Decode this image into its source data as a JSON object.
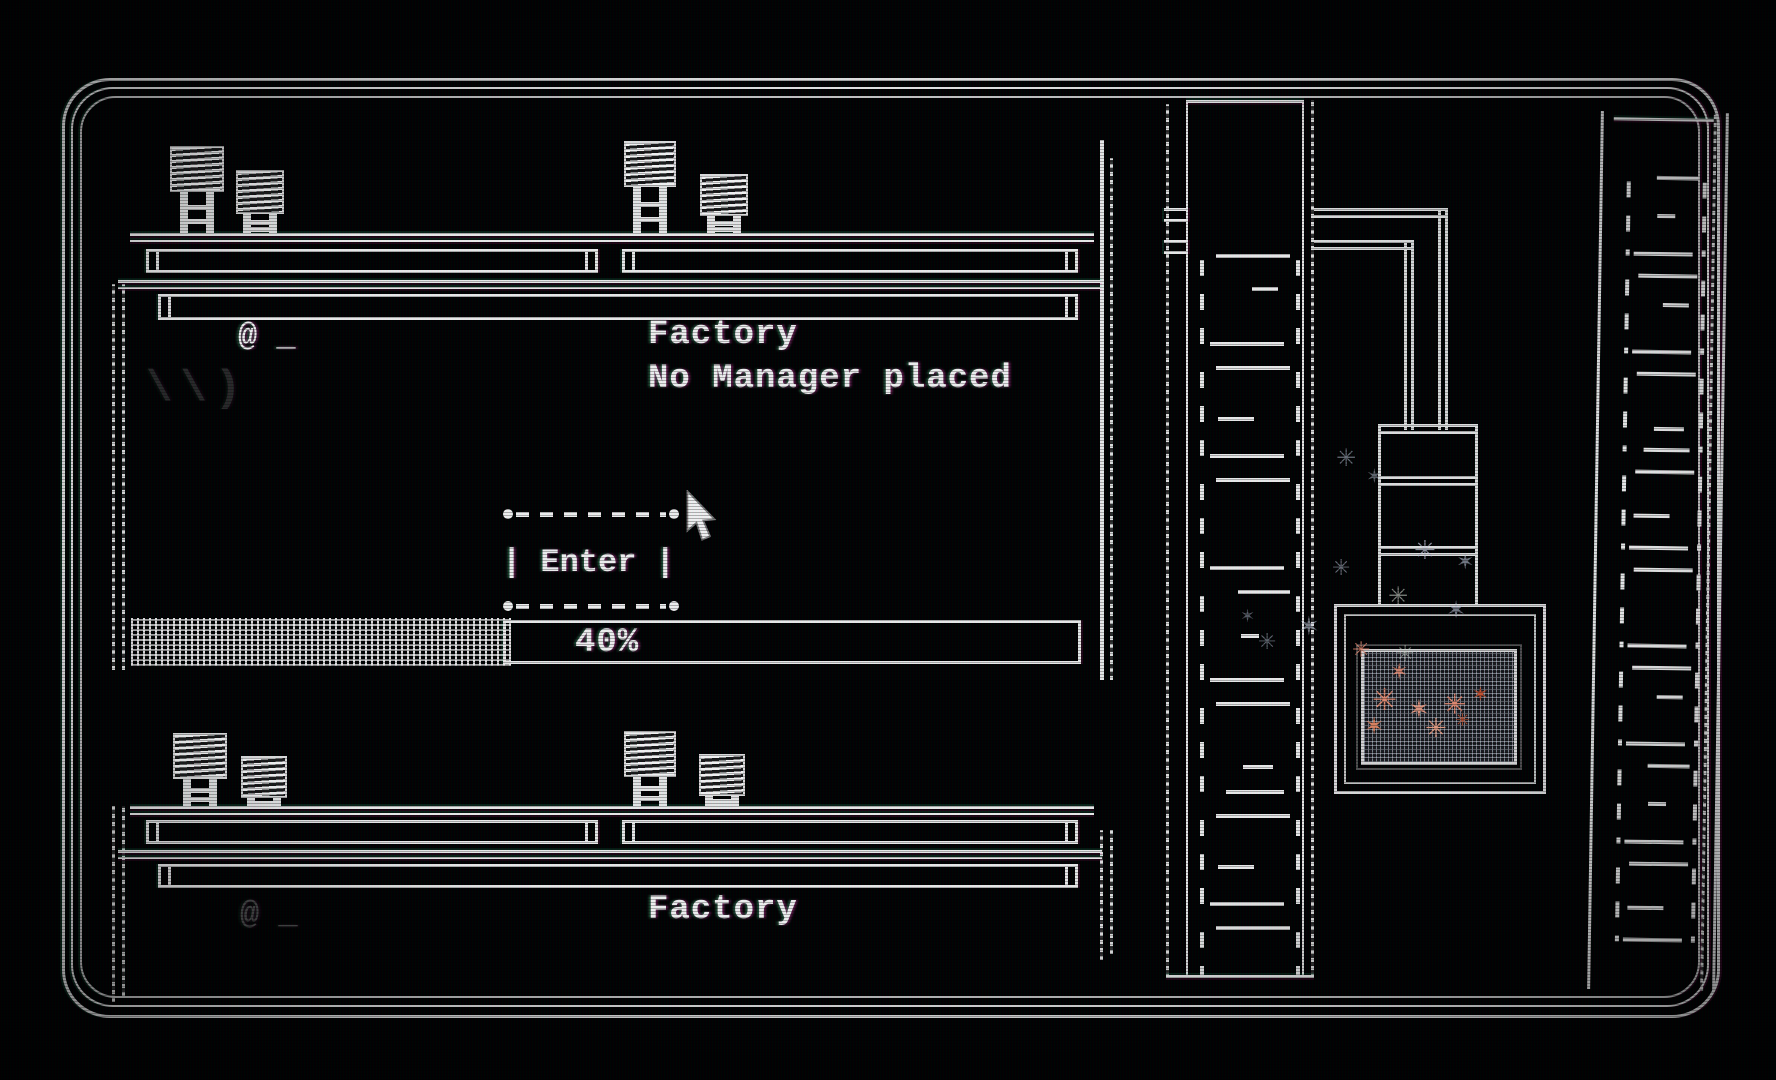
{
  "rooms": {
    "top": {
      "title": "Factory",
      "status": "No Manager placed",
      "player_prompt": "@ _",
      "ghost_marks": "\\\\)",
      "enter_button": {
        "label": "| Enter |"
      },
      "progress": {
        "label": "40%",
        "percent": 40
      }
    },
    "bottom": {
      "title": "Factory",
      "player_prompt": "@ _"
    }
  },
  "decor": {
    "middle_strip_glyphs": [
      "a",
      "b",
      "c",
      "d",
      "e",
      "b",
      "c"
    ],
    "right_strip_glyphs": [
      "d",
      "a",
      "e",
      "b",
      "c",
      "a",
      "d",
      "b"
    ],
    "spark_colors": {
      "pale": "#b9c3d6",
      "ember": "#e0886e",
      "hot": "#c2512f"
    },
    "cursor": "arrow-pointer"
  },
  "colors": {
    "line": "#e9e9e9",
    "text": "#f0f0f0",
    "background": "#000000"
  }
}
